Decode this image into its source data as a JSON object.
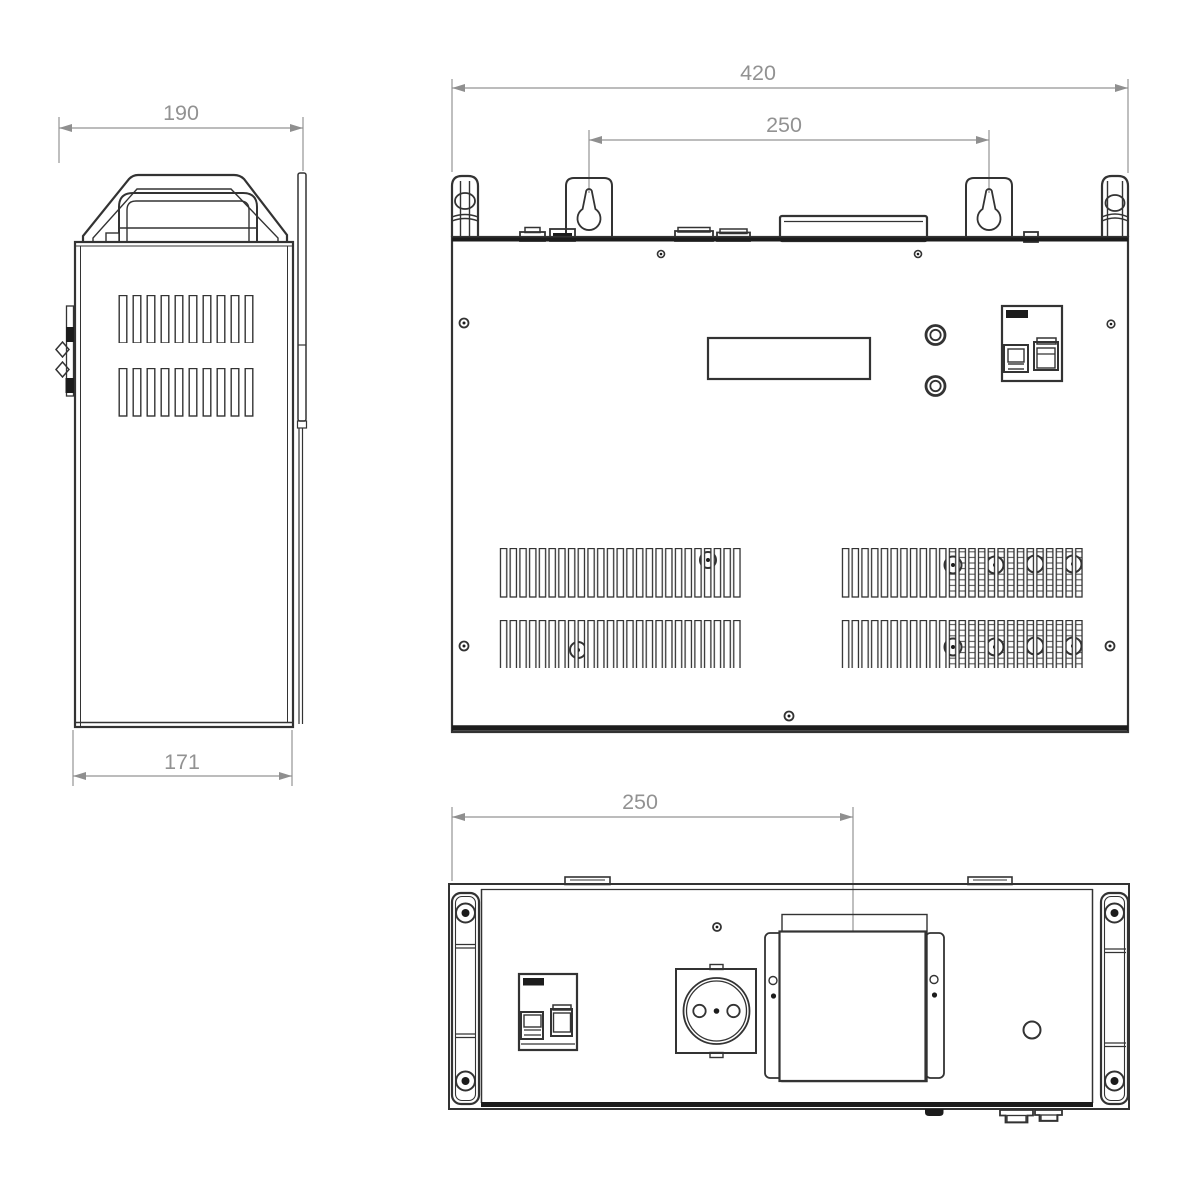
{
  "drawing": {
    "type": "technical-drawing",
    "views": {
      "side": {
        "width_label": "190",
        "depth_label": "171"
      },
      "front": {
        "overall_width_label": "420",
        "mount_spacing_label": "250"
      },
      "bottom": {
        "mount_offset_label": "250"
      }
    },
    "colors": {
      "background": "#ffffff",
      "line": "#333333",
      "heavy_line": "#1c1c1c",
      "dimension": "#929292"
    }
  }
}
